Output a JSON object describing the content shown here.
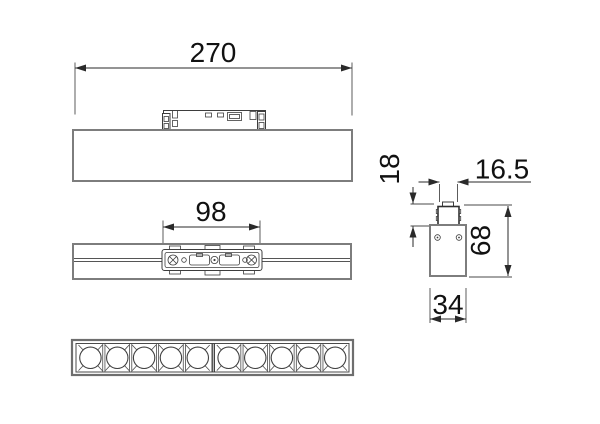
{
  "colors": {
    "background": "#ffffff",
    "object_outline": "#7d7d7d",
    "detail_line": "#3d3d3d",
    "dimension_line": "#2a2a2a",
    "dimension_text": "#111111"
  },
  "views": {
    "front": {
      "dim_length": "270"
    },
    "plan": {
      "dim_connector": "98"
    },
    "side": {
      "dim_stem_height": "18",
      "dim_stem_width": "16.5",
      "dim_total_height": "68",
      "dim_body_width": "34"
    },
    "bottom": {
      "lens_count": 10,
      "modules": 2
    }
  }
}
